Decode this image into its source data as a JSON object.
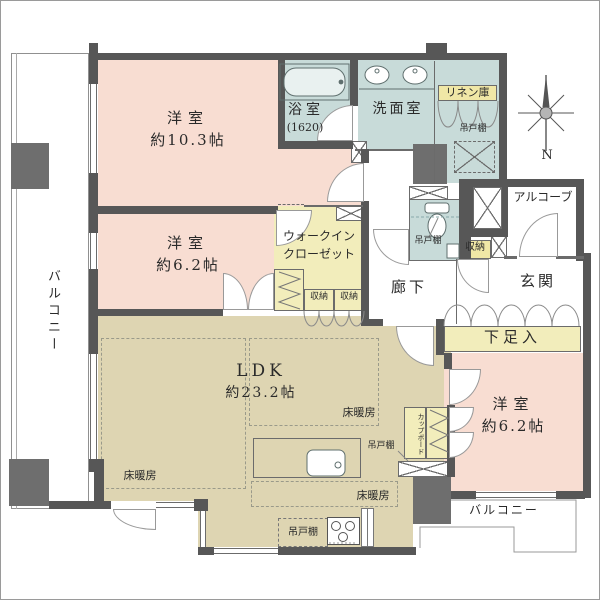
{
  "rooms": {
    "bedroom1": {
      "name": "洋室",
      "size": "約10.3帖"
    },
    "bedroom2": {
      "name": "洋室",
      "size": "約6.2帖"
    },
    "bedroom3": {
      "name": "洋室",
      "size": "約6.2帖"
    },
    "ldk": {
      "name": "LDK",
      "size": "約23.2帖"
    },
    "bath": {
      "name": "浴室",
      "size": "(1620)"
    },
    "washroom": {
      "name": "洗面室"
    },
    "wic": {
      "line1": "ウォークイン",
      "line2": "クローゼット"
    },
    "entrance": {
      "name": "玄関"
    },
    "hallway": {
      "name": "廊下"
    },
    "alcove": {
      "name": "アルコーブ"
    },
    "balcony": {
      "name": "バルコニー"
    }
  },
  "labels": {
    "linen": "リネン庫",
    "hanging_cupboard": "吊戸棚",
    "storage": "収納",
    "shoe_cabinet": "下足入",
    "floor_heating": "床暖房",
    "cupboard": "カップボード",
    "compass_north": "N"
  },
  "colors": {
    "room_pink": "#f8ddd2",
    "ldk_beige": "#ded5b2",
    "wet_blue": "#c8dbd9",
    "closet_yellow": "#f2edbb",
    "tag_yellow": "#f0e7a6",
    "wall": "#575757",
    "block_gray": "#6e6e6e"
  }
}
